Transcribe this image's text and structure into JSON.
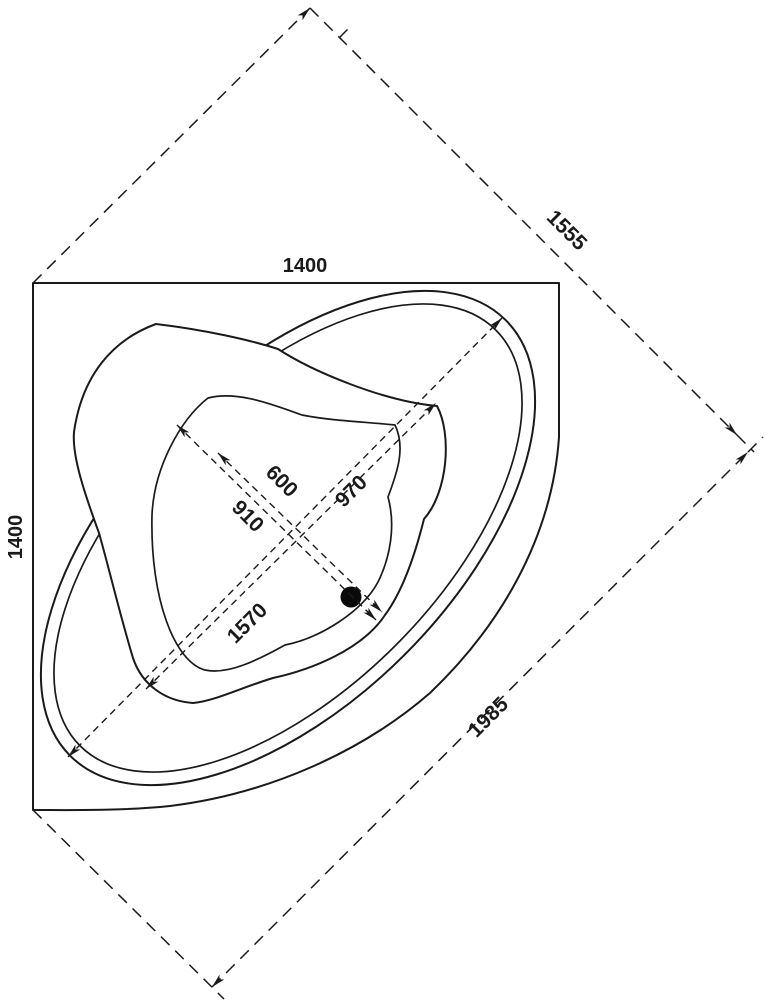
{
  "drawing": {
    "overall": {
      "top_width": "1400",
      "side_depth": "1400",
      "corner_diagonal": "1555",
      "front_diagonal": "1985"
    },
    "rim": {
      "length": "1570",
      "width": "910"
    },
    "basin": {
      "length": "970",
      "width": "600"
    }
  }
}
